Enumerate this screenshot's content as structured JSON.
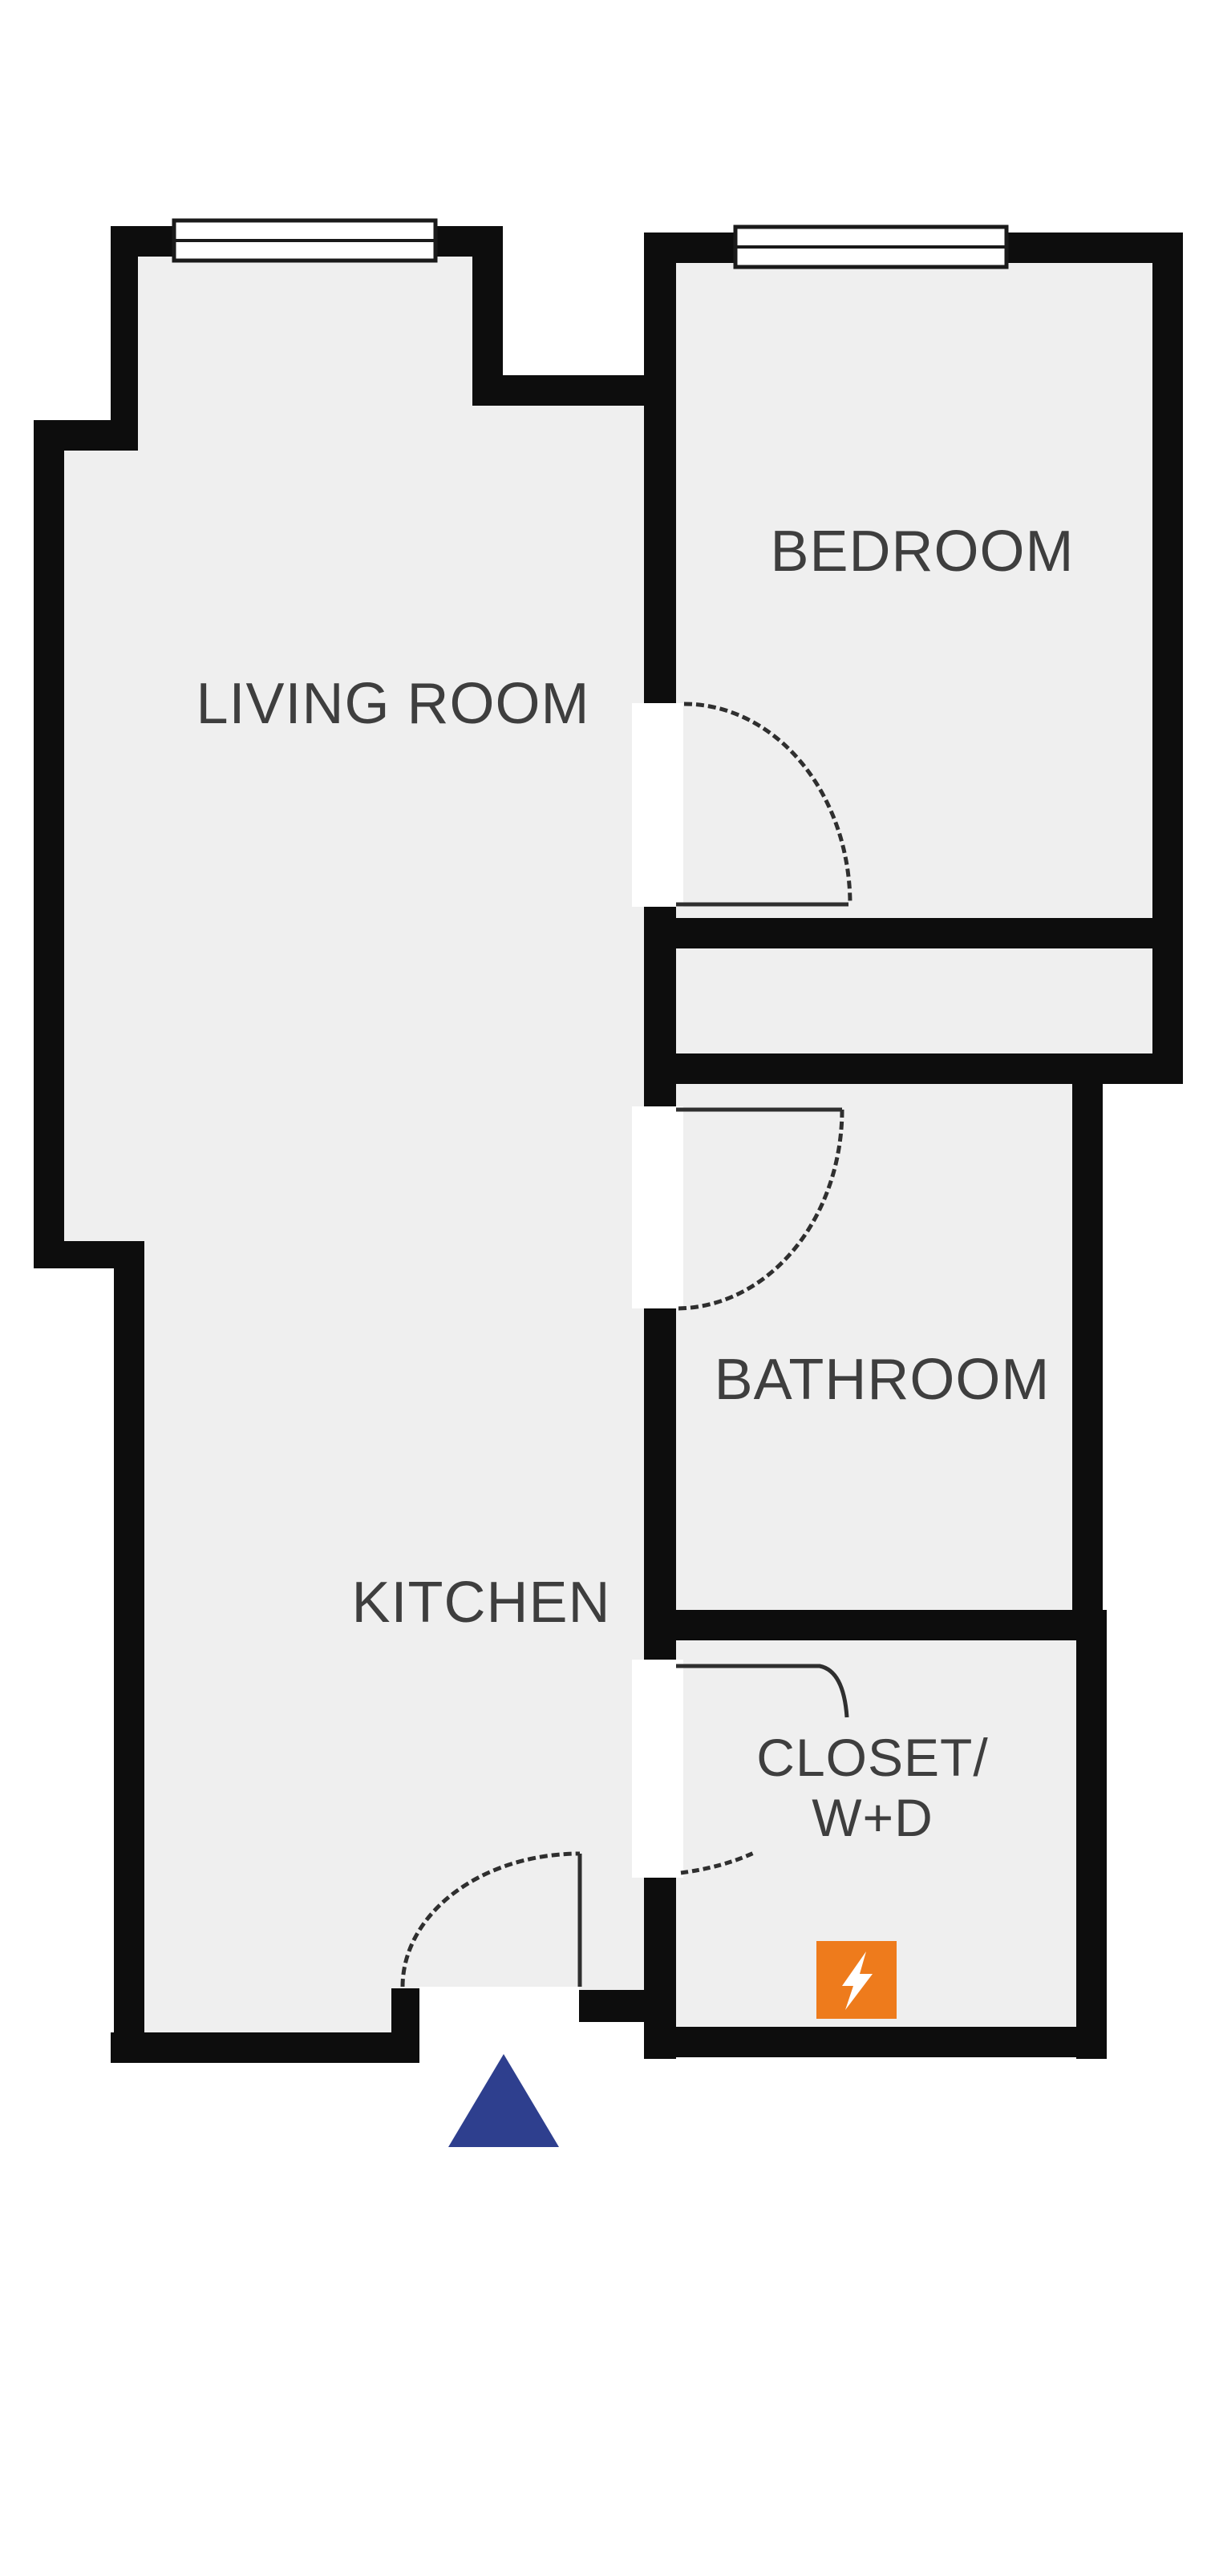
{
  "floorplan": {
    "rooms": [
      {
        "label": "LIVING ROOM"
      },
      {
        "label": "BEDROOM"
      },
      {
        "label": "BATHROOM"
      },
      {
        "label": "KITCHEN"
      },
      {
        "label": "CLOSET/",
        "label_line2": "W+D"
      }
    ],
    "colors": {
      "wall": "#0d0d0d",
      "floor": "#efefef",
      "outside": "#ffffff",
      "label_text": "#3e3e3e",
      "power_icon_bg": "#ee7b1c",
      "power_icon_glyph": "#ffffff",
      "entry_marker": "#2e3f8e"
    },
    "icons": {
      "power": "lightning-bolt-icon",
      "entry": "entrance-triangle-marker"
    }
  }
}
